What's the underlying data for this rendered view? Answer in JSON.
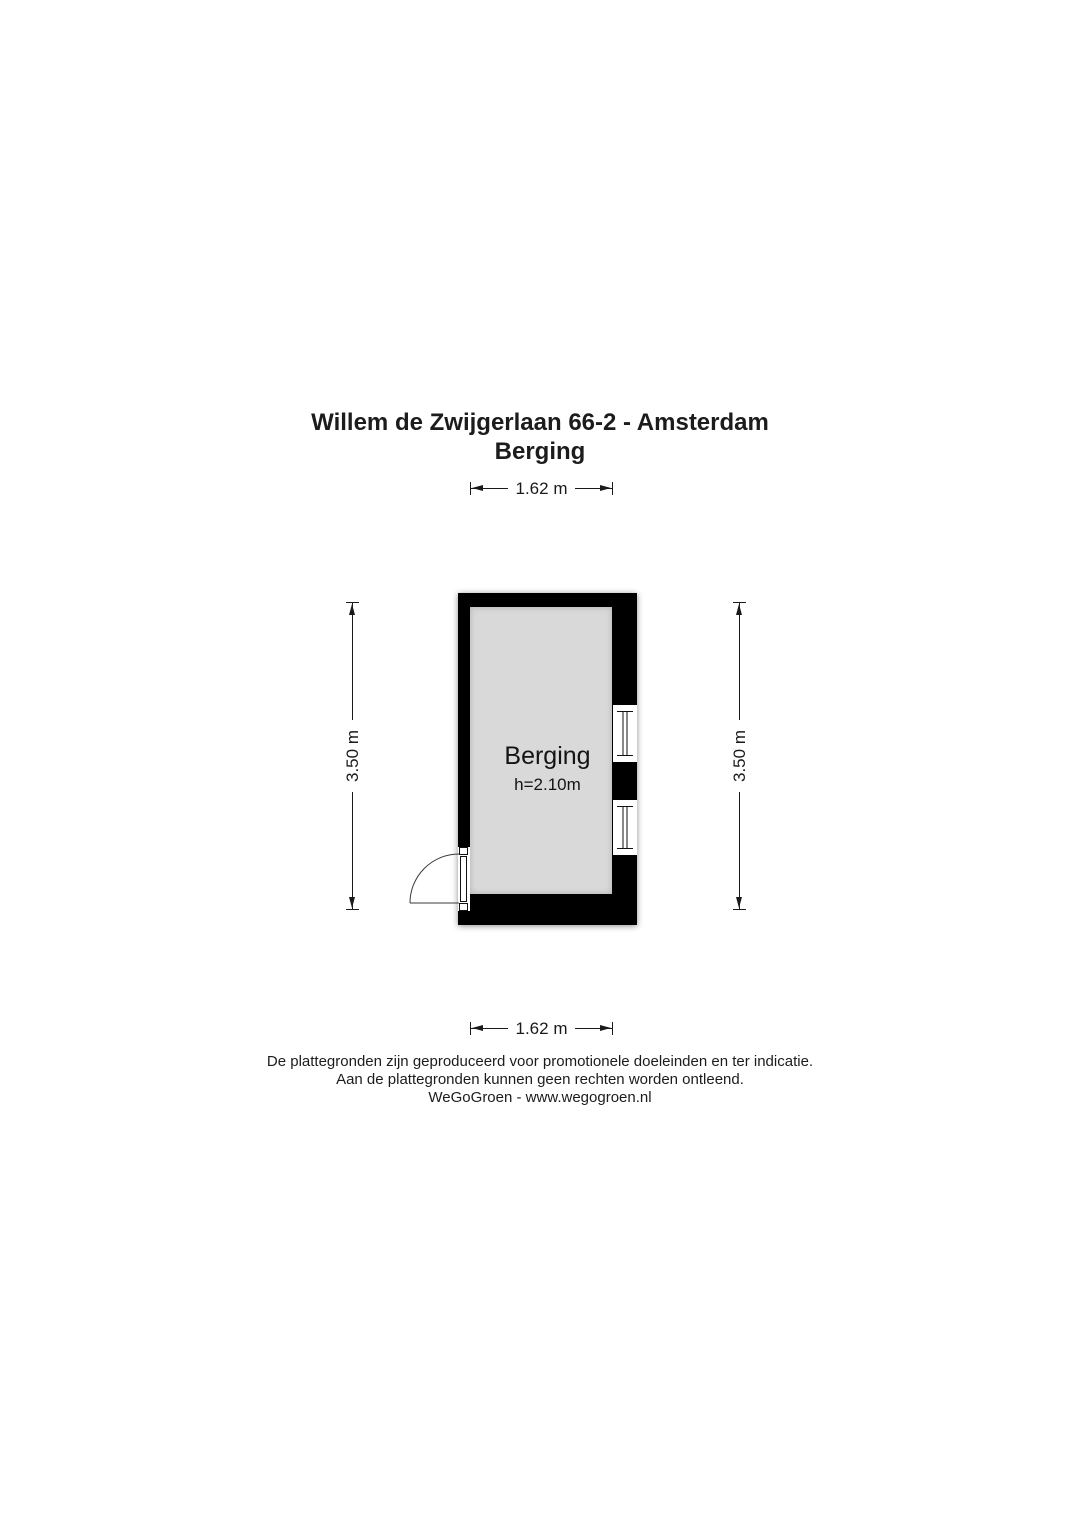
{
  "title": {
    "line1": "Willem de Zwijgerlaan 66-2 - Amsterdam",
    "line2": "Berging"
  },
  "floorplan": {
    "room": {
      "name": "Berging",
      "height_label": "h=2.10m"
    },
    "features": {
      "windows_right_wall": 2,
      "door_bottom_left": "swings outward to the left"
    },
    "colors": {
      "wall": "#000000",
      "floor": "#d9d9d9",
      "line": "#1a1a1a"
    }
  },
  "dimensions": {
    "top": "1.62 m",
    "bottom": "1.62 m",
    "left": "3.50 m",
    "right": "3.50 m"
  },
  "footer": {
    "line1": "De plattegronden zijn geproduceerd voor promotionele doeleinden en ter indicatie.",
    "line2": "Aan de plattegronden kunnen geen rechten worden ontleend.",
    "line3": "WeGoGroen -  www.wegogroen.nl"
  }
}
